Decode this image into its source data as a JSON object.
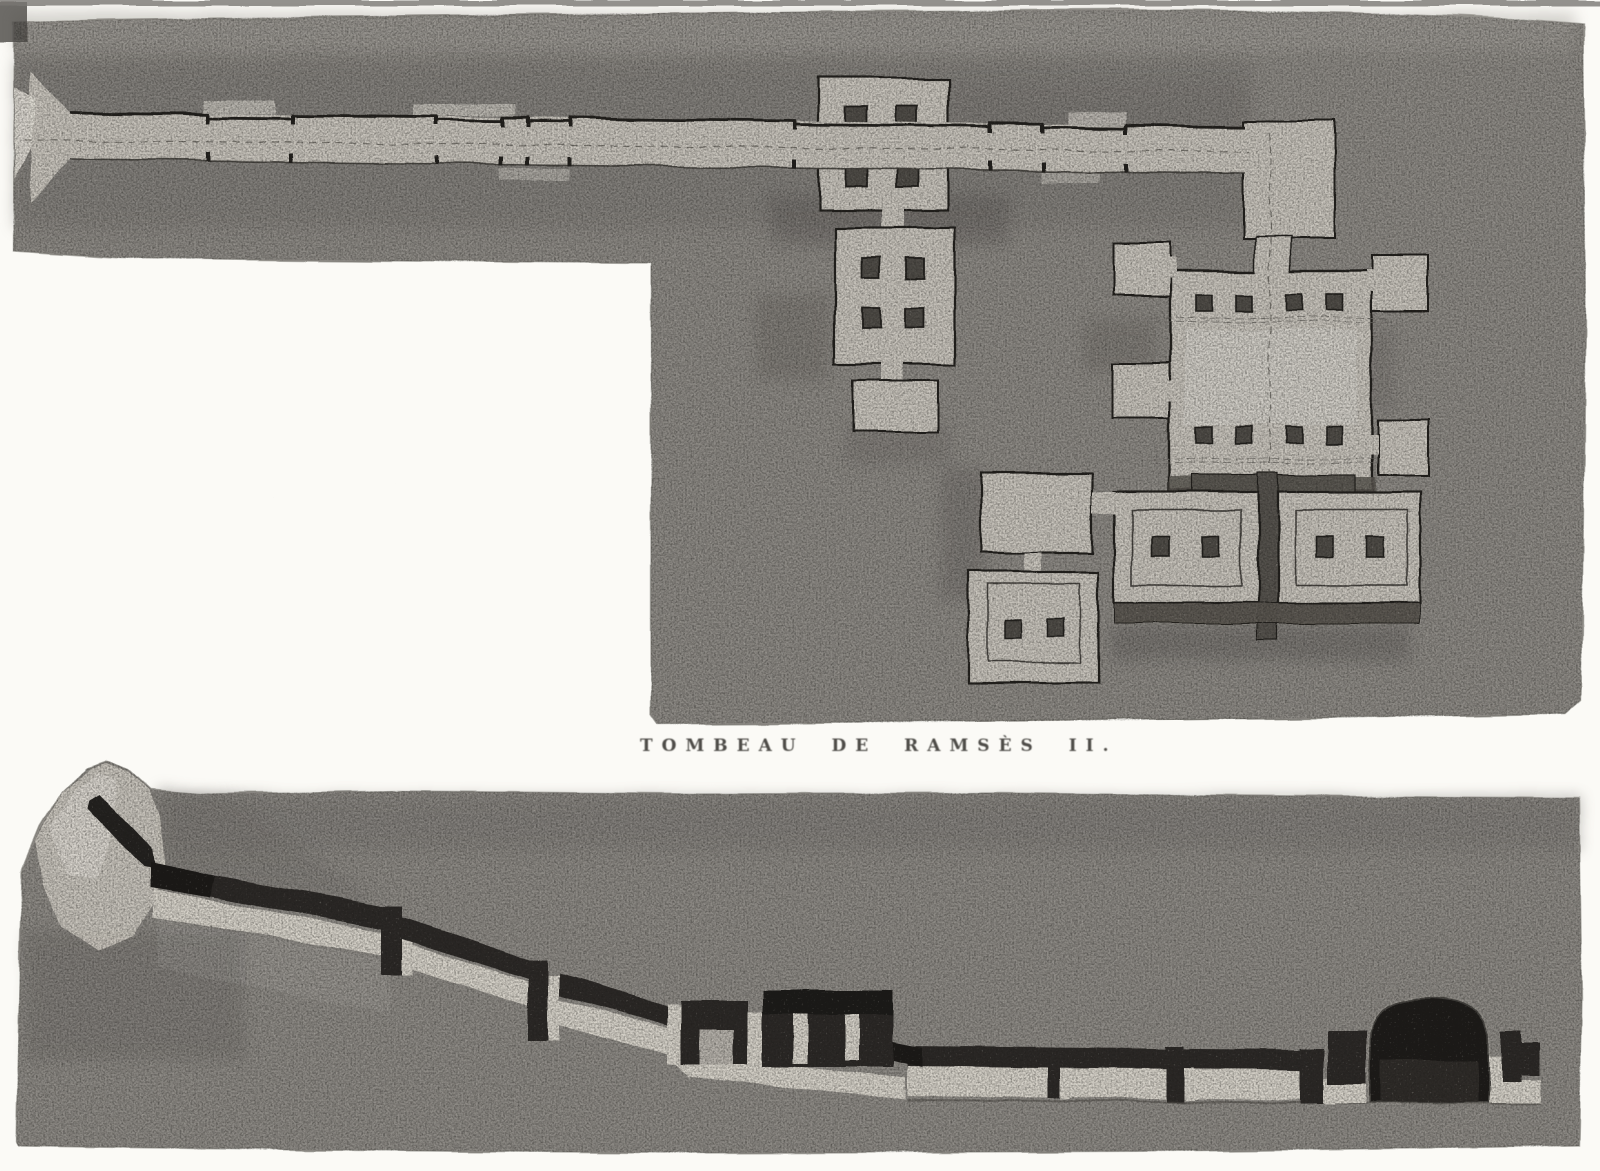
{
  "plate": {
    "caption": "TOMBEAU DE RAMSÈS II.",
    "figures": [
      {
        "id": "plan",
        "label": "plan-view-of-tomb"
      },
      {
        "id": "section",
        "label": "longitudinal-section-of-tomb"
      }
    ],
    "palette": {
      "page": "#fbfaf6",
      "rock": "#8d8a85",
      "rock_dark": "#7b7874",
      "rock_light": "#a5a29c",
      "cut": "#c9c5bd",
      "cut_bright": "#d7d3ca",
      "pillar": "#4f4c47",
      "ink": "#211f1c",
      "void": "#2b2826",
      "vault": "#1c1a18",
      "caption_text": "#3f3d39"
    }
  }
}
